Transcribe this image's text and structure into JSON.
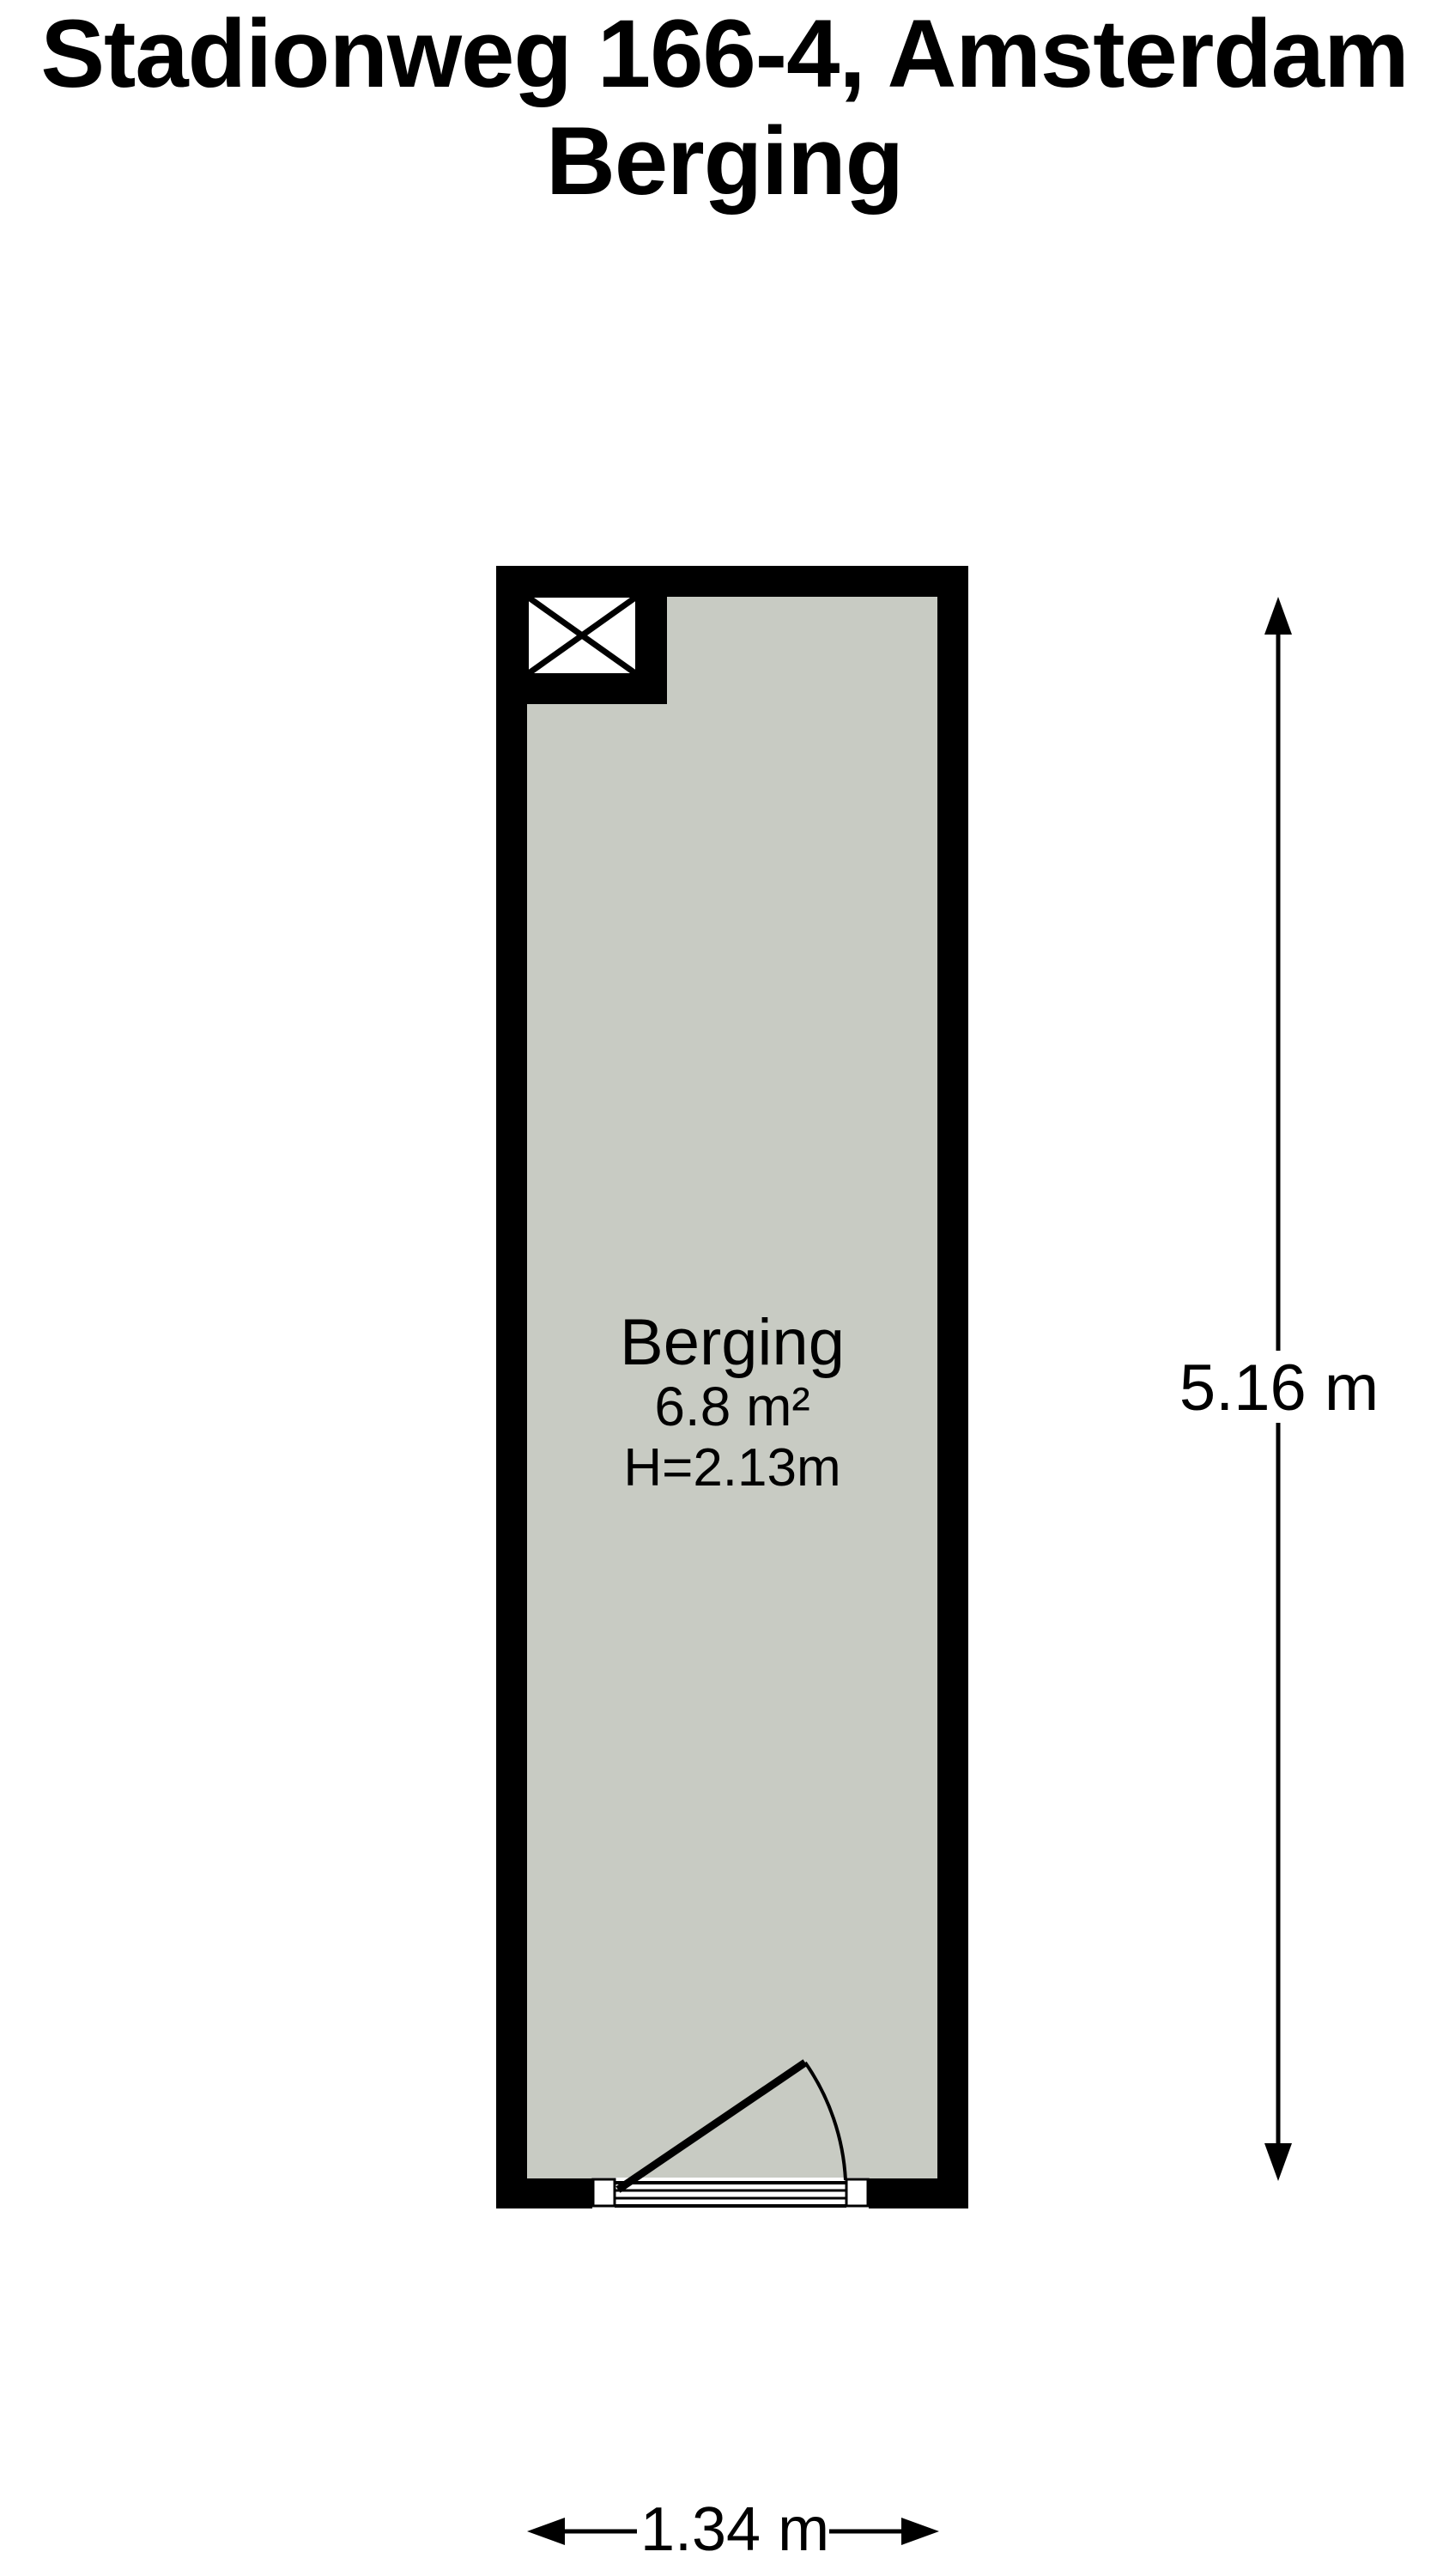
{
  "title": {
    "line1": "Stadionweg 166-4, Amsterdam",
    "line2": "Berging"
  },
  "room": {
    "name": "Berging",
    "area": "6.8 m²",
    "ceiling_height": "H=2.13m"
  },
  "dimensions": {
    "height_label": "5.16 m",
    "width_label": "1.34 m"
  },
  "colors": {
    "wall": "#000000",
    "floor_fill": "#c8cbc3",
    "background": "#ffffff",
    "text": "#000000"
  },
  "icons": {
    "shaft": "crossed-box-shaft-symbol",
    "door": "door-swing-arc",
    "dimension": "double-headed-arrow"
  }
}
